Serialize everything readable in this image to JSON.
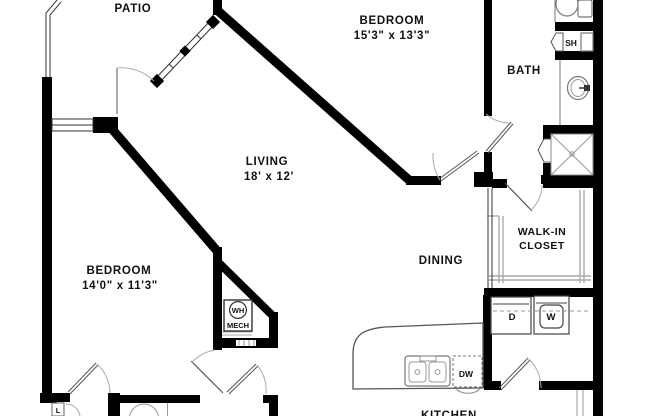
{
  "floorplan": {
    "rooms": {
      "patio": {
        "label": "PATIO"
      },
      "bedroom1": {
        "label": "BEDROOM",
        "dims": "15'3\" x 13'3\""
      },
      "bath": {
        "label": "BATH"
      },
      "living": {
        "label": "LIVING",
        "dims": "18' x 12'"
      },
      "walk_in_closet": {
        "line1": "WALK-IN",
        "line2": "CLOSET"
      },
      "bedroom2": {
        "label": "BEDROOM",
        "dims": "14'0\" x 11'3\""
      },
      "dining": {
        "label": "DINING"
      },
      "kitchen": {
        "label": "KITCHEN"
      }
    },
    "fixtures": {
      "shelf": "SH",
      "water_heater": "WH",
      "mechanical": "MECH",
      "dryer": "D",
      "washer": "W",
      "dishwasher": "DW",
      "linen": "L"
    },
    "colors": {
      "wall": "#000000",
      "background": "#ffffff",
      "fixture_line": "#777777",
      "door_arc": "#aaaaaa"
    }
  }
}
